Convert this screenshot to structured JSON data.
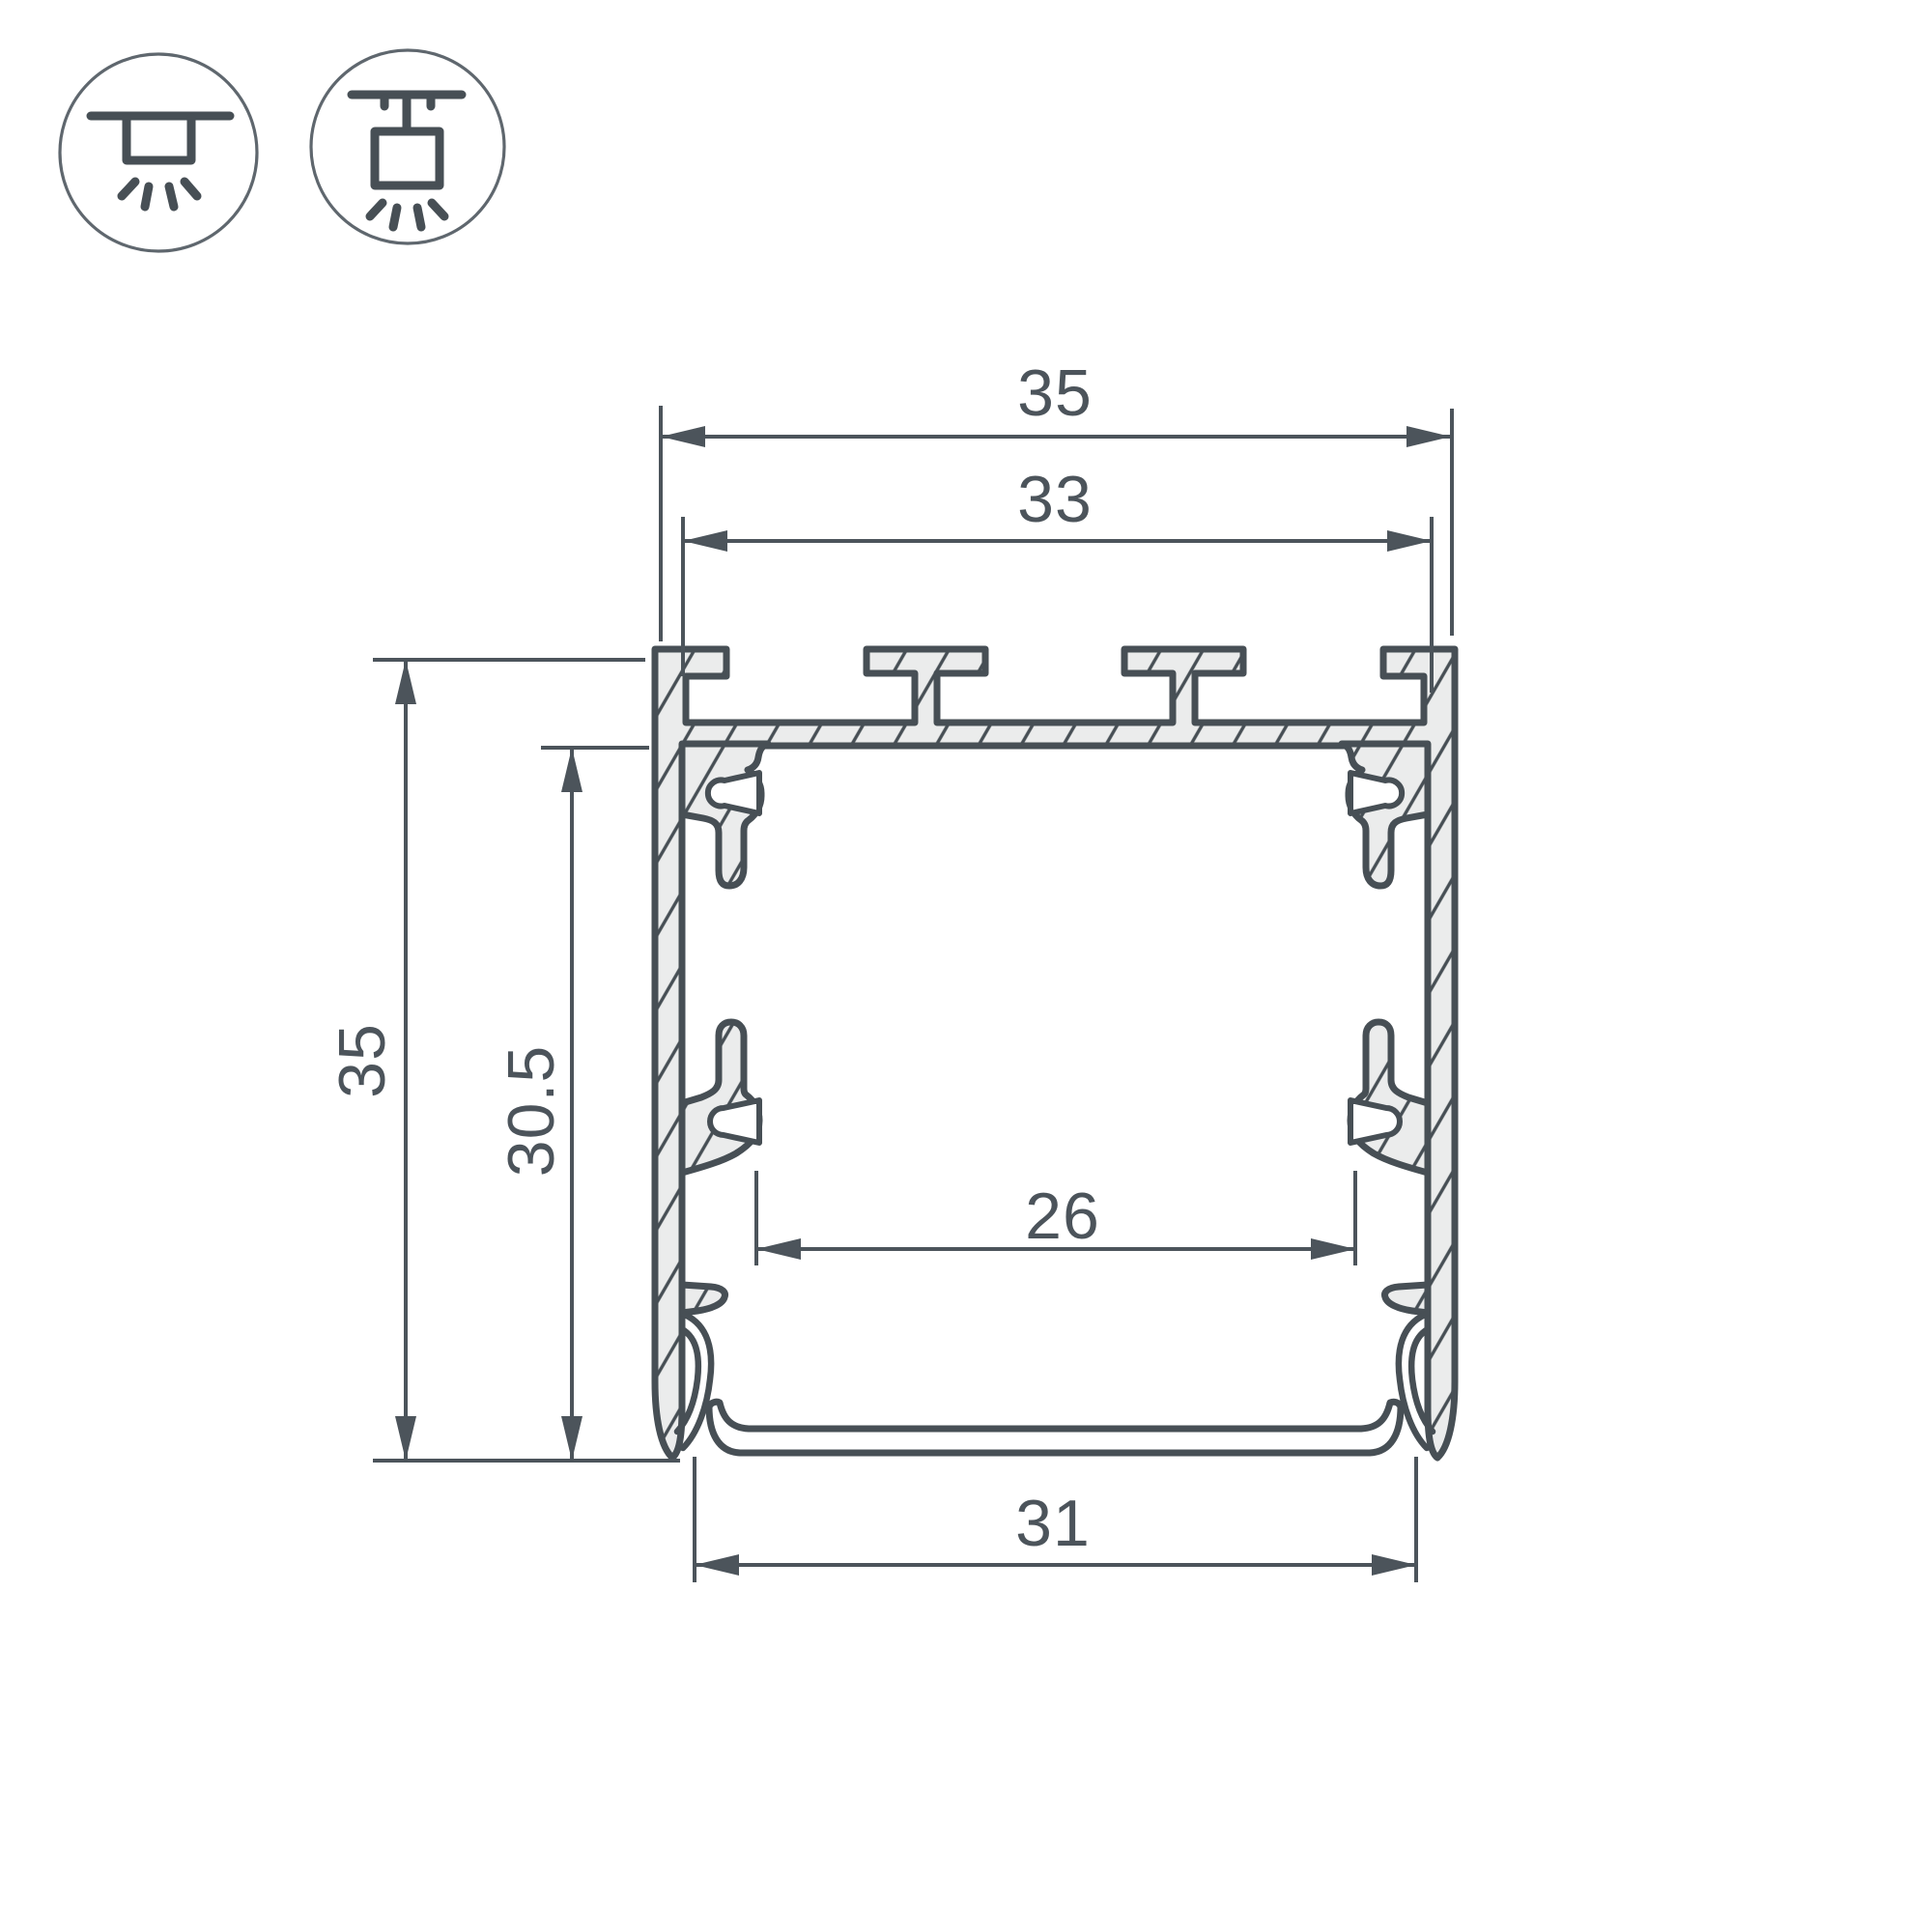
{
  "icons": [
    {
      "name": "surface-mount-icon"
    },
    {
      "name": "pendant-mount-icon"
    }
  ],
  "dimensions": {
    "outer_width": "35",
    "mount_slot_width": "33",
    "outer_height": "35",
    "inner_depth": "30.5",
    "inner_width": "26",
    "opening_width": "31"
  },
  "colors": {
    "line": "#474f55",
    "dimension": "#4c545b",
    "aluminum_fill": "#ebecec",
    "background": "#ffffff"
  }
}
